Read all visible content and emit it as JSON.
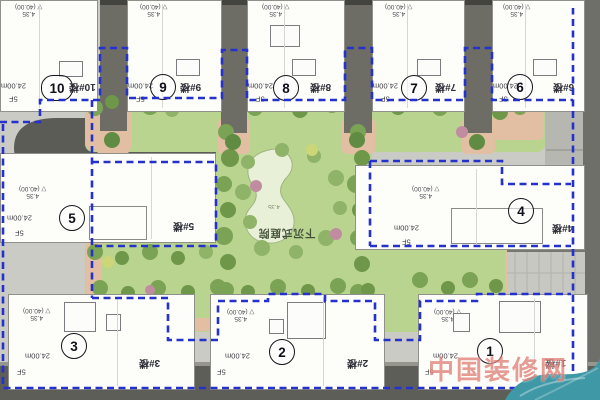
{
  "site": {
    "colors": {
      "boundary_blue": "#2531cc",
      "lawn_green": "#b9d48e",
      "tree_green": "#7ba355",
      "path_pink": "#e2bfa2",
      "road_gray": "#5e5e58",
      "building_white": "#fdfdfa",
      "teal_blob": "#3e98a6",
      "watermark_red": "#cd372a"
    }
  },
  "garden": {
    "label": "下沉式庭院",
    "pond_note": "4.35"
  },
  "watermark": {
    "text": "中国装修网"
  },
  "buildings": [
    {
      "number": "1",
      "label": "1#楼",
      "height": "24.00m",
      "floors": "5F",
      "elevation": "4.35",
      "datum": "(40.00)"
    },
    {
      "number": "2",
      "label": "2#楼",
      "height": "24.00m",
      "floors": "5F",
      "elevation": "4.35",
      "datum": "(40.00)"
    },
    {
      "number": "3",
      "label": "3#楼",
      "height": "24.00m",
      "floors": "5F",
      "elevation": "4.35",
      "datum": "(40.00)"
    },
    {
      "number": "4",
      "label": "4#楼",
      "height": "24.00m",
      "floors": "5F",
      "elevation": "4.35",
      "datum": "(40.00)"
    },
    {
      "number": "5",
      "label": "5#楼",
      "height": "24.00m",
      "floors": "5F",
      "elevation": "4.35",
      "datum": "(40.00)"
    },
    {
      "number": "6",
      "label": "6#楼",
      "height": "24.00m",
      "floors": "5F",
      "elevation": "4.35",
      "datum": "(40.00)"
    },
    {
      "number": "7",
      "label": "7#楼",
      "height": "24.00m",
      "floors": "5F",
      "elevation": "4.35",
      "datum": "(40.00)"
    },
    {
      "number": "8",
      "label": "8#楼",
      "height": "24.00m",
      "floors": "5F",
      "elevation": "4.35",
      "datum": "(40.00)"
    },
    {
      "number": "9",
      "label": "9#楼",
      "height": "24.00m",
      "floors": "5F",
      "elevation": "4.35",
      "datum": "(40.00)"
    },
    {
      "number": "10",
      "label": "10#楼",
      "height": "24.00m",
      "floors": "5F",
      "elevation": "4.35",
      "datum": "(40.00)"
    }
  ]
}
